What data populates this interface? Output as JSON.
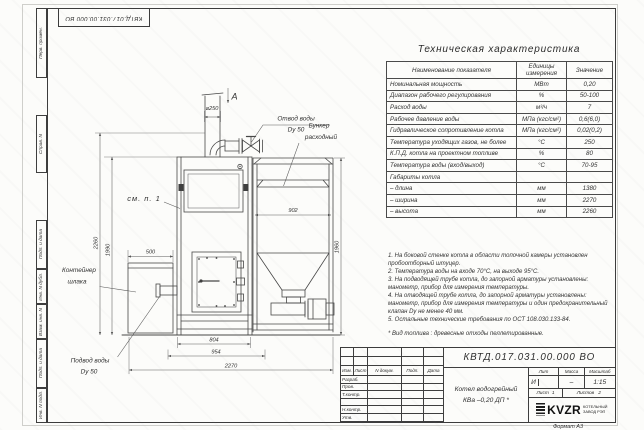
{
  "frame": {
    "doc_number_flipped": "КВТД.017.031.00.000 ВО",
    "format_note": "Формат А3",
    "margin_labels": [
      "Перв. примен.",
      "Справ. N",
      "Подп. и дата",
      "Инв. N дубл.",
      "Взам. инв. N",
      "Подп. и дата",
      "Инв. N подл."
    ]
  },
  "drawing": {
    "view_arrow": "А",
    "dim_chimney": "⌀250",
    "see_note": "см. п. 1",
    "label_water_out_1": "Отвод воды",
    "label_water_out_2": "Dy 50",
    "label_bunker_1": "Бункер",
    "label_bunker_2": "расходный",
    "label_slag_1": "Контейнер",
    "label_slag_2": "шлака",
    "label_water_in_1": "Подвод воды",
    "label_water_in_2": "Dy 50",
    "dim_2260": "2260",
    "dim_1990": "1990",
    "dim_500": "500",
    "dim_902": "902",
    "dim_1960": "1960",
    "dim_804": "804",
    "dim_954": "954",
    "dim_2270": "2270"
  },
  "table": {
    "title": "Техническая характеристика",
    "headers": [
      "Наименование показателя",
      "Единицы измерения",
      "Значение"
    ],
    "rows": [
      [
        "Номинальная мощность",
        "МВт",
        "0,20"
      ],
      [
        "Диапазон рабочего регулирования",
        "%",
        "50-100"
      ],
      [
        "Расход воды",
        "м³/ч",
        "7"
      ],
      [
        "Рабочее давление воды",
        "МПа (кгс/см²)",
        "0,6(6,0)"
      ],
      [
        "Гидравлическое сопротивление котла",
        "МПа (кгс/см²)",
        "0,02(0,2)"
      ],
      [
        "Температура уходящих газов, не более",
        "°С",
        "250"
      ],
      [
        "К.П.Д. котла на проектном топливе",
        "%",
        "80"
      ],
      [
        "Температура воды (вход/выход)",
        "°С",
        "70-95"
      ],
      [
        "Габариты котла",
        "",
        ""
      ],
      [
        "– длина",
        "мм",
        "1380"
      ],
      [
        "– ширина",
        "мм",
        "2270"
      ],
      [
        "– высота",
        "мм",
        "2260"
      ]
    ]
  },
  "notes": [
    "1. На боковой стенке котла в области топочной камеры установлен пробоотборный штуцер.",
    "2. Температура воды на входе 70°С, на выходе 95°С.",
    "3. На подводящей трубе котла, до запорной арматуры установлены: манометр, прибор для измерения температуры.",
    "4. На отводящей трубе котла, до запорной арматуры установлены: манометр, прибор для измерения температуры и один предохранительный клапан Dу не менее 40 мм.",
    "5. Остальные технические требования по ОСТ 108.030.133-84.",
    "* Вид топлива : древесные отходы пеллетированные."
  ],
  "title_block": {
    "doc_number": "КВТД.017.031.00.000  ВО",
    "columns": [
      "Изм.",
      "Лист",
      "N докум.",
      "Подп.",
      "Дата"
    ],
    "rows": [
      "Разраб.",
      "Пров.",
      "Т.контр.",
      "",
      "Н.контр.",
      "Утв."
    ],
    "name_line1": "Котел водогрейный",
    "name_line2": "КВа –0,20  ДП *",
    "lit_label": "Лит",
    "mass_label": "Масса",
    "scale_label": "Масштаб",
    "lit_value": "И",
    "mass_value": "–",
    "scale_value": "1:15",
    "sheet_label": "Лист",
    "sheet_value": "1",
    "sheets_label": "Листов",
    "sheets_value": "2",
    "logo_icon": "kvzr-spring-bars",
    "logo_text": "KVZR",
    "logo_sub1": "КОТЕЛЬНЫЙ",
    "logo_sub2": "ЗАВОД РЭП"
  }
}
